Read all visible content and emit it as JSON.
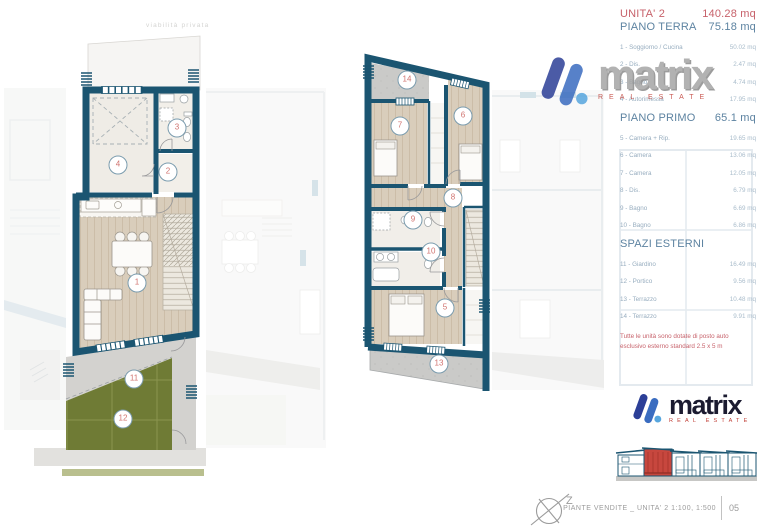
{
  "plan": {
    "road_label": "viabilità privata"
  },
  "labels": {
    "1": "1",
    "2": "2",
    "3": "3",
    "4": "4",
    "5": "5",
    "6": "6",
    "7": "7",
    "8": "8",
    "9": "9",
    "10": "10",
    "11": "11",
    "12": "12",
    "13": "13",
    "14": "14"
  },
  "panel": {
    "unit_label": "UNITA' 2",
    "unit_area": "140.28 mq",
    "piano_terra": {
      "title": "PIANO TERRA",
      "area": "75.18 mq",
      "rows": [
        {
          "label": "1 - Soggiorno / Cucina",
          "value": "50.02 mq"
        },
        {
          "label": "2 - Dis.",
          "value": "2.47 mq"
        },
        {
          "label": "3 - Bagno",
          "value": "4.74 mq"
        },
        {
          "label": "4 - Autorimessa",
          "value": "17.95 mq"
        }
      ]
    },
    "piano_primo": {
      "title": "PIANO PRIMO",
      "area": "65.1 mq",
      "rows": [
        {
          "label": "5 - Camera + Rip.",
          "value": "19.65 mq"
        },
        {
          "label": "6 - Camera",
          "value": "13.06 mq"
        },
        {
          "label": "7 - Camera",
          "value": "12.05 mq"
        },
        {
          "label": "8 - Dis.",
          "value": "6.79 mq"
        },
        {
          "label": "9 - Bagno",
          "value": "6.69 mq"
        },
        {
          "label": "10 - Bagno",
          "value": "6.86 mq"
        }
      ]
    },
    "spazi_esterni": {
      "title": "SPAZI ESTERNI",
      "rows": [
        {
          "label": "11 - Giardino",
          "value": "16.49 mq"
        },
        {
          "label": "12 - Portico",
          "value": "9.56 mq"
        },
        {
          "label": "13 - Terrazzo",
          "value": "10.48 mq"
        },
        {
          "label": "14 - Terrazzo",
          "value": "9.91 mq"
        }
      ]
    },
    "note_line1": "Tutte le unità sono dotate di posto auto",
    "note_line2": "esclusivo esterno standard 2.5 x 5 m"
  },
  "logo": {
    "name": "matrix",
    "tagline": "REAL ESTATE"
  },
  "footer": {
    "caption": "PIANTE VENDITE _ UNITA' 2 1:100, 1:500",
    "sheet": "05",
    "compass": "Z"
  },
  "colors": {
    "wall": "#1b5571",
    "coral": "#c7626b",
    "steel_blue": "#5d83a1",
    "garden": "#6f7b35",
    "terrace": "#cacac8",
    "logo_dark_blue": "#2c3f97",
    "logo_mid_blue": "#3a6cc0",
    "logo_light_blue": "#57a6de",
    "logo_red": "#c14038",
    "highlight_red": "#c7473e"
  }
}
